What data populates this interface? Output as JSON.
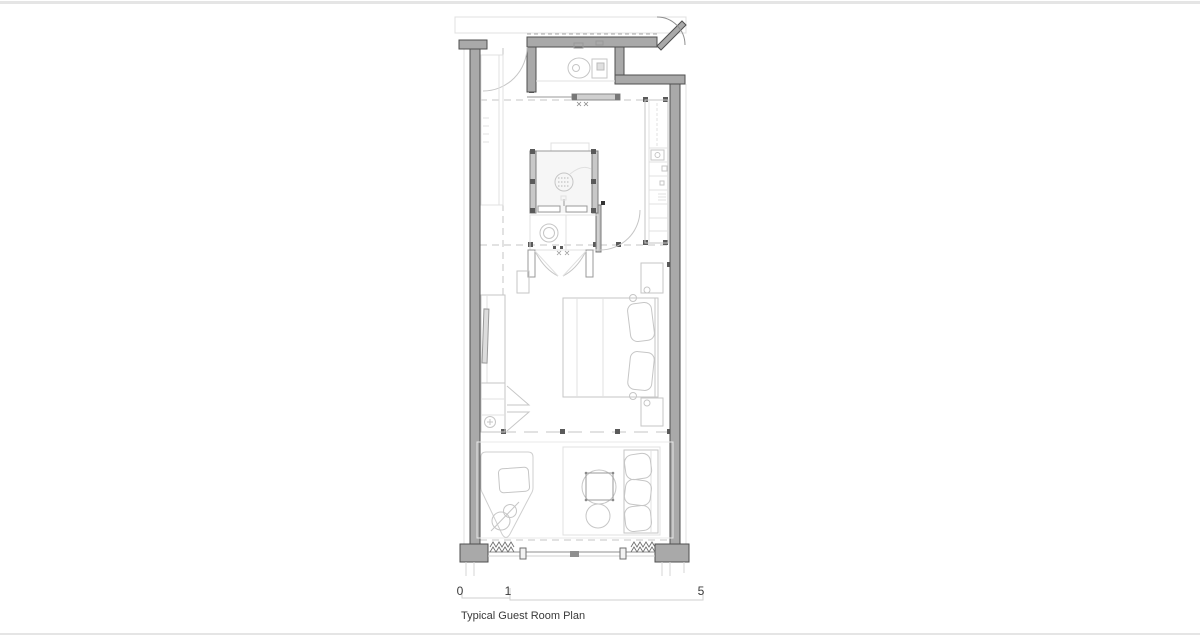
{
  "sheet": {
    "title": "Typical Guest Room Plan"
  },
  "scale_bar": {
    "labels": {
      "zero": "0",
      "one": "1",
      "five": "5"
    }
  },
  "colors": {
    "background": "#ffffff",
    "frame_line": "#e5e5e5",
    "wall_fill": "#a9a9a9",
    "wall_stroke": "#4f4f4f",
    "line_light": "#c6c6c6",
    "line_mid": "#999999",
    "line_faint": "#e0e0e0",
    "marker": "#5a5a5a",
    "text": "#3a3a3a"
  }
}
